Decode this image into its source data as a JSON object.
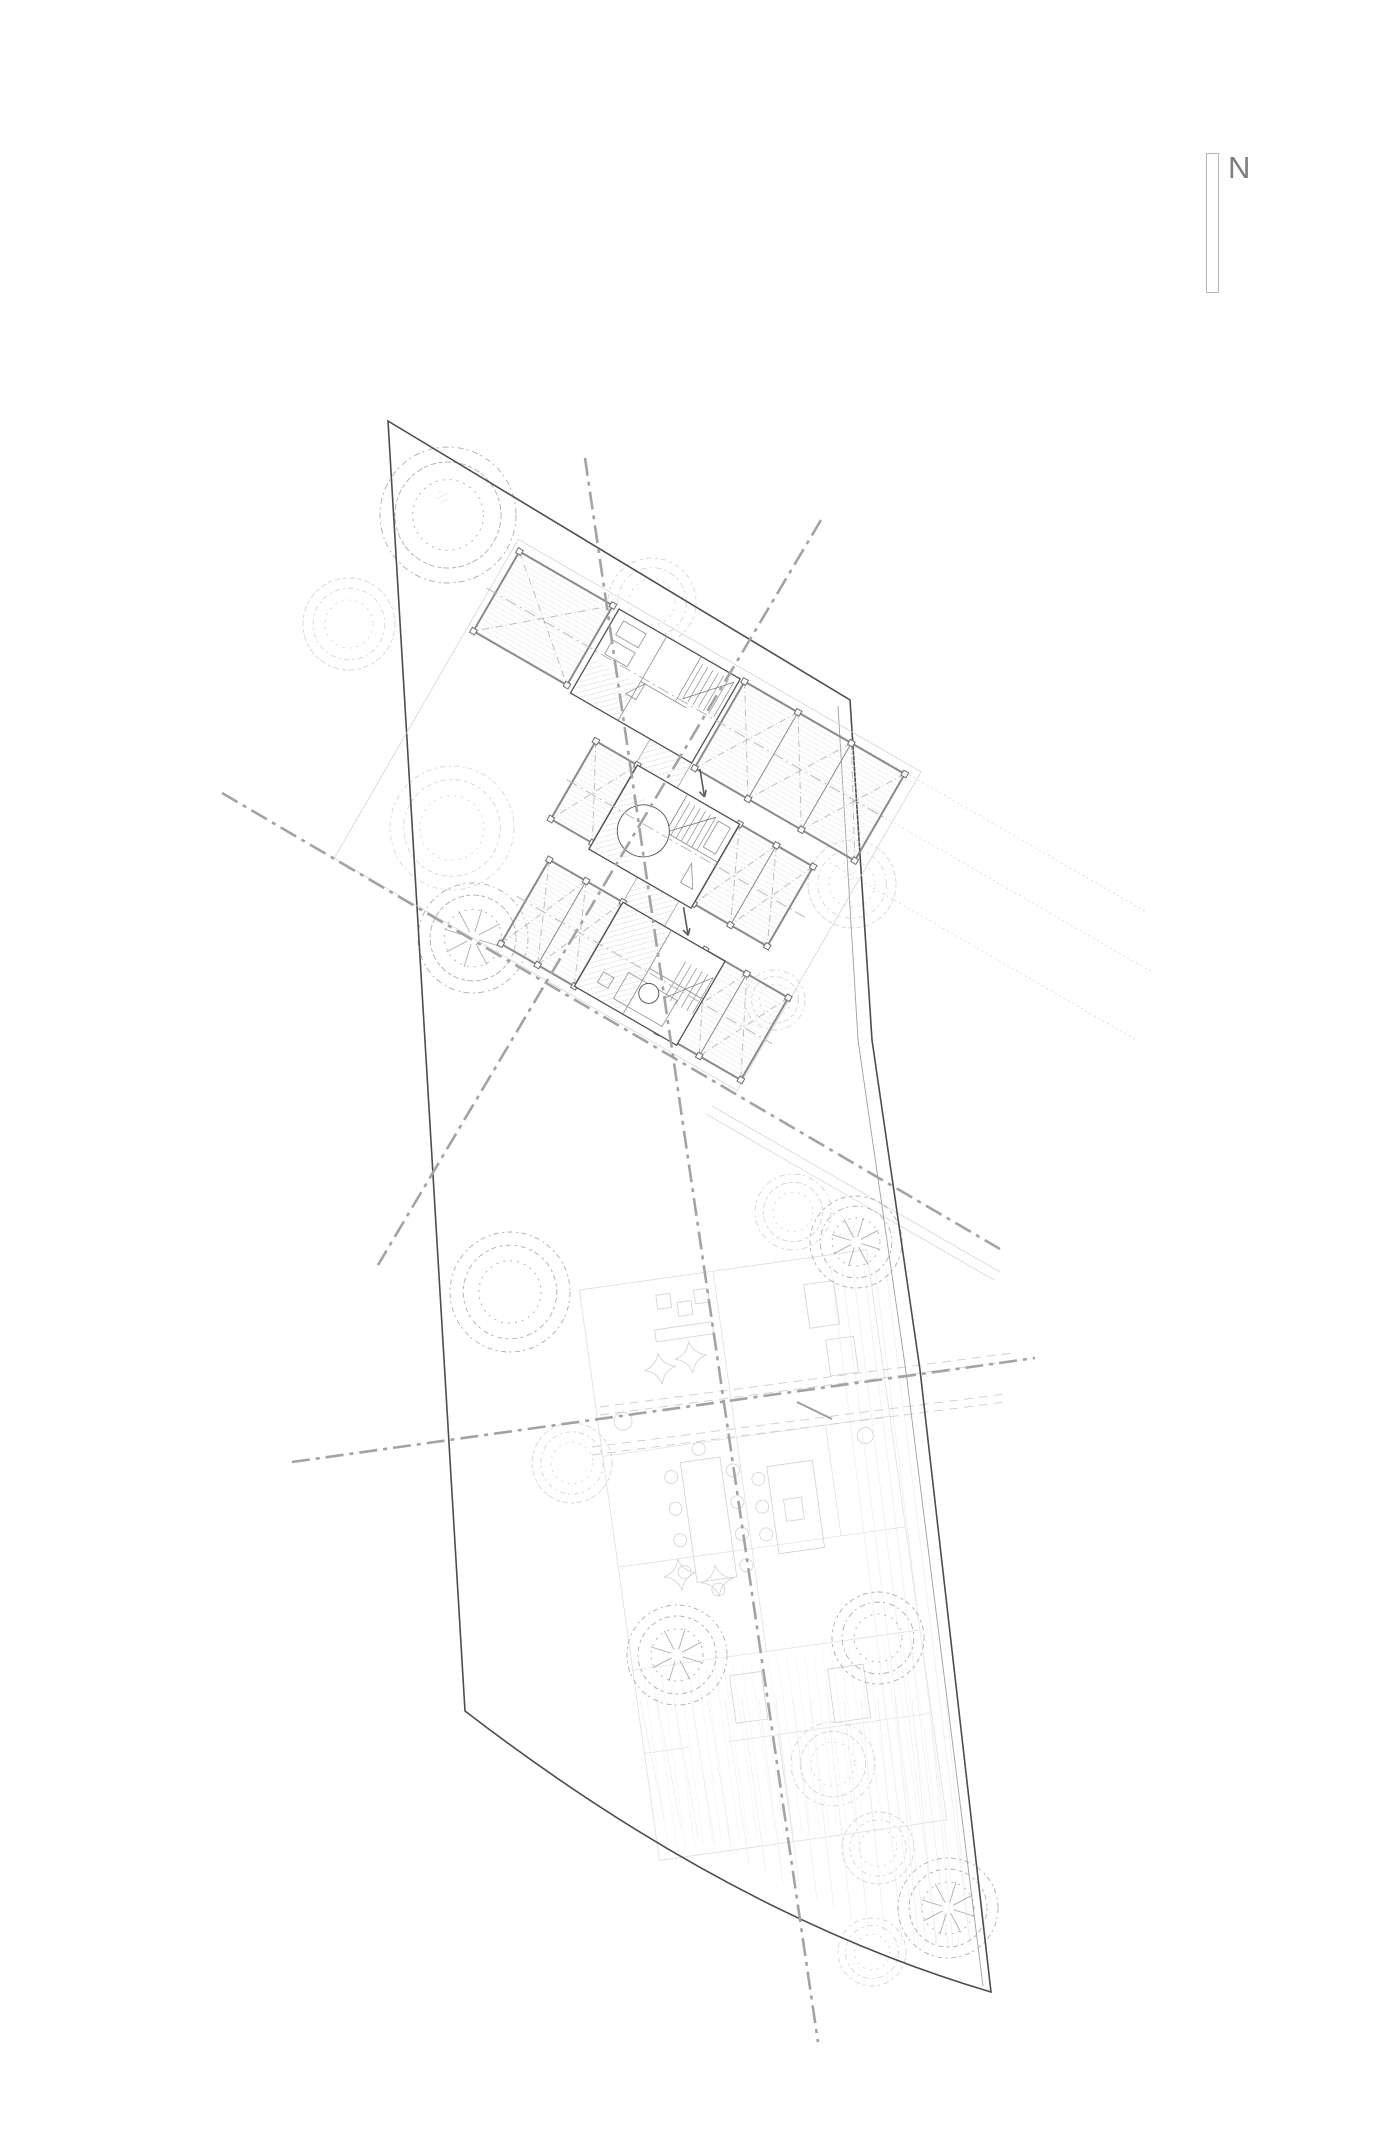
{
  "meta": {
    "drawing_type": "architectural-site-plan",
    "background": "#ffffff",
    "width": 1390,
    "height": 2148
  },
  "north": {
    "label": "N",
    "bar": {
      "x": 1206,
      "y": 153,
      "w": 13,
      "h": 140
    },
    "label_pos": {
      "x": 1228,
      "y": 150
    }
  },
  "palette": {
    "boundary": "#4d4d4d",
    "boundaryInner": "#9f9f9f",
    "axis": "#a3a3a3",
    "deck": "#8a8a8a",
    "house": "#525252",
    "houseDetail": "#8f8f8f",
    "brace": "#b8b8b8",
    "clusterOutline": "#d0d0d0",
    "treeLight": "#d6d6d6",
    "treeMedium": "#aeaeae",
    "ghost": "#dedede",
    "ghostFurniture": "#d2d2d2",
    "guide": "#cdcdcd",
    "projection": "#d8d8d8",
    "texture": "#ededed",
    "hatch": "#c9c9c9",
    "boards": "#e9e9e9",
    "arrow": "#5a5a5a",
    "northText": "#7d7d7d",
    "northBar": "#b5b5b5"
  },
  "site": {
    "top_corner": [
      388,
      421
    ],
    "right_corner": [
      850,
      700
    ],
    "right_edge": [
      [
        850,
        700
      ],
      [
        872,
        1040
      ],
      [
        920,
        1370
      ],
      [
        991,
        1992
      ]
    ],
    "bottom_curve_ctrl": [
      730,
      1915
    ],
    "bottom_left_corner": [
      465,
      1711
    ],
    "inner_path": [
      [
        838,
        706
      ],
      [
        858,
        1040
      ],
      [
        906,
        1372
      ],
      [
        983,
        1986
      ]
    ]
  },
  "axes": [
    {
      "name": "axis-lower-long",
      "from": [
        292,
        1462
      ],
      "to": [
        1035,
        1358
      ]
    },
    {
      "name": "axis-vertical",
      "from": [
        585,
        458
      ],
      "to": [
        818,
        2042
      ]
    },
    {
      "name": "axis-upper-cross",
      "from": [
        821,
        520
      ],
      "to": [
        378,
        1265
      ]
    },
    {
      "name": "axis-upper-long",
      "from": [
        222,
        793
      ],
      "to": [
        1000,
        1249
      ]
    }
  ],
  "guides": [
    {
      "from": [
        600,
        1407
      ],
      "to": [
        1012,
        1353
      ]
    },
    {
      "from": [
        600,
        1415
      ],
      "to": [
        1012,
        1361
      ]
    },
    {
      "from": [
        592,
        1447
      ],
      "to": [
        1005,
        1394
      ]
    },
    {
      "from": [
        592,
        1455
      ],
      "to": [
        1005,
        1402
      ]
    }
  ],
  "projections": [
    {
      "from": [
        840,
        735
      ],
      "to": [
        1148,
        913
      ],
      "dotted": true
    },
    {
      "from": [
        846,
        795
      ],
      "to": [
        1152,
        972
      ],
      "dotted": true
    },
    {
      "from": [
        830,
        863
      ],
      "to": [
        1138,
        1041
      ],
      "dotted": true
    },
    {
      "from": [
        712,
        1106
      ],
      "to": [
        1000,
        1272
      ],
      "dotted": false
    },
    {
      "from": [
        706,
        1114
      ],
      "to": [
        994,
        1280
      ],
      "dotted": false
    }
  ],
  "tick": [
    797,
    1402,
    832,
    1419
  ],
  "trees": [
    {
      "x": 448,
      "y": 515,
      "r": 68,
      "tone": "medium",
      "patch": true
    },
    {
      "x": 349,
      "y": 624,
      "r": 46,
      "tone": "light",
      "patch": false
    },
    {
      "x": 452,
      "y": 828,
      "r": 62,
      "tone": "light",
      "patch": false
    },
    {
      "x": 652,
      "y": 602,
      "r": 44,
      "tone": "light",
      "patch": false
    },
    {
      "x": 473,
      "y": 938,
      "r": 55,
      "tone": "medium",
      "star": true
    },
    {
      "x": 852,
      "y": 884,
      "r": 44,
      "tone": "light",
      "patch": true
    },
    {
      "x": 510,
      "y": 1292,
      "r": 60,
      "tone": "medium"
    },
    {
      "x": 856,
      "y": 1242,
      "r": 46,
      "tone": "medium",
      "patch": true,
      "star": true
    },
    {
      "x": 793,
      "y": 1212,
      "r": 38,
      "tone": "light"
    },
    {
      "x": 572,
      "y": 1463,
      "r": 40,
      "tone": "light"
    },
    {
      "x": 677,
      "y": 1655,
      "r": 50,
      "tone": "medium",
      "star": true
    },
    {
      "x": 878,
      "y": 1638,
      "r": 46,
      "tone": "medium"
    },
    {
      "x": 833,
      "y": 1764,
      "r": 42,
      "tone": "light"
    },
    {
      "x": 878,
      "y": 1848,
      "r": 36,
      "tone": "light"
    },
    {
      "x": 948,
      "y": 1908,
      "r": 50,
      "tone": "medium",
      "star": true
    },
    {
      "x": 872,
      "y": 1952,
      "r": 34,
      "tone": "light"
    },
    {
      "x": 775,
      "y": 1000,
      "r": 30,
      "tone": "light"
    }
  ],
  "cluster": {
    "origin": [
      619,
      609
    ],
    "angle": 30,
    "outline": [
      -122,
      -10,
      465,
      368
    ],
    "houses": [
      {
        "x": 0,
        "y": 0,
        "w": 140,
        "h": 97,
        "hatch": [
          2,
          56,
          51,
          39
        ],
        "stair": {
          "x": 100,
          "y": 6,
          "w": 36,
          "h": 40,
          "steps": 6
        },
        "details": [
          "M55,0 V97",
          "M55,52 H108",
          "M95,0 V52",
          "M10,8 h26 v16 h-26 z",
          "M10,30 h26 v16 h-26 z",
          "M60,52 l-12,18 h12 z"
        ]
      },
      {
        "x": 94,
        "y": 126,
        "w": 118,
        "h": 97,
        "hatch": [
          2,
          26,
          40,
          68
        ],
        "circle": {
          "cx": 38,
          "cy": 54,
          "r": 26
        },
        "stair": {
          "x": 58,
          "y": 6,
          "w": 36,
          "h": 38,
          "steps": 6
        },
        "details": [
          "M58,0 V44",
          "M58,44 H118",
          "M96,58 l14,22 h-14 z",
          "M98,8 h14 v30 h-14 z"
        ]
      },
      {
        "x": 150,
        "y": 252,
        "w": 118,
        "h": 97,
        "hatch": [
          2,
          2,
          56,
          93
        ],
        "circle": {
          "cx": 68,
          "cy": 66,
          "r": 10
        },
        "stair": {
          "x": 84,
          "y": 20,
          "w": 32,
          "h": 42,
          "steps": 5
        },
        "details": [
          "M56,0 V97",
          "M56,44 H118",
          "M40,58 h56 v30 h-56 z",
          "M18,70 h12 v12 h-12 z"
        ]
      }
    ],
    "decks": [
      {
        "x": -115,
        "y": 0,
        "w": 108,
        "h": 92,
        "panels": 1
      },
      {
        "x": 145,
        "y": 0,
        "w": 185,
        "h": 100,
        "panels": 3
      },
      {
        "x": 46,
        "y": 126,
        "w": 48,
        "h": 90,
        "panels": 1
      },
      {
        "x": 212,
        "y": 126,
        "w": 85,
        "h": 92,
        "panels": 2
      },
      {
        "x": 65,
        "y": 252,
        "w": 85,
        "h": 97,
        "panels": 2
      },
      {
        "x": 245,
        "y": 252,
        "w": 96,
        "h": 95,
        "panels": 2
      }
    ],
    "connectors": [
      [
        92,
        97,
        48,
        29
      ],
      [
        150,
        223,
        48,
        29
      ]
    ],
    "centerlines": [
      [
        -125,
        48,
        335,
        48
      ],
      [
        40,
        174,
        315,
        174
      ],
      [
        55,
        300,
        350,
        300
      ]
    ],
    "arrows": [
      {
        "from": [
          150,
          98
        ],
        "to": [
          168,
          120
        ]
      },
      {
        "from": [
          205,
          226
        ],
        "to": [
          223,
          248
        ]
      }
    ]
  },
  "ghost": {
    "center": [
      763,
      1555
    ],
    "angle": -8,
    "half": [
      145,
      288
    ],
    "walls": [
      "M-145,-120 H145",
      "M-145,-8 H145",
      "M-145,96 H145",
      "M-10,-288 V96",
      "M80,-120 V-8",
      "M-60,180 H145",
      "M-10,180 V288",
      "M-145,180 H-100"
    ],
    "rects": [
      [
        -69,
        -103,
        40,
        121
      ],
      [
        16,
        -87,
        46,
        88
      ],
      [
        28,
        -52,
        18,
        22
      ],
      [
        -70,
        -272,
        14,
        14
      ],
      [
        -50,
        -262,
        14,
        14
      ],
      [
        -32,
        -272,
        14,
        14
      ],
      [
        -76,
        -238,
        58,
        12
      ],
      [
        78,
        -262,
        30,
        44
      ],
      [
        92,
        -204,
        28,
        36
      ],
      [
        -50,
        115,
        32,
        48
      ],
      [
        48,
        122,
        36,
        54
      ]
    ],
    "chairs": [
      [
        -80,
        -90
      ],
      [
        -80,
        -58
      ],
      [
        -80,
        -26
      ],
      [
        -80,
        6
      ],
      [
        -18,
        -88
      ],
      [
        -18,
        -56
      ],
      [
        -18,
        -24
      ],
      [
        -18,
        8
      ],
      [
        -49,
        -114
      ],
      [
        -49,
        28
      ],
      [
        6,
        -76
      ],
      [
        6,
        -48
      ],
      [
        6,
        -20
      ]
    ],
    "diamonds": [
      [
        -76,
        -199
      ],
      [
        -44,
        -206
      ],
      [
        -85,
        8
      ],
      [
        -49,
        19
      ]
    ],
    "plants": [
      [
        -120,
        -152,
        9
      ],
      [
        118,
        -104,
        8
      ]
    ],
    "stripes": {
      "x0": -135,
      "x1": 135,
      "step": 9,
      "y0": 104,
      "y1": 278
    }
  },
  "texture": {
    "bottom_band": {
      "x0": 640,
      "x1": 958,
      "step": 17,
      "lean": 24
    },
    "right_band": {
      "count": 6,
      "top_x": 886,
      "bot_x": 970,
      "dx": -11,
      "y0": 1268,
      "y1": 1944
    }
  }
}
